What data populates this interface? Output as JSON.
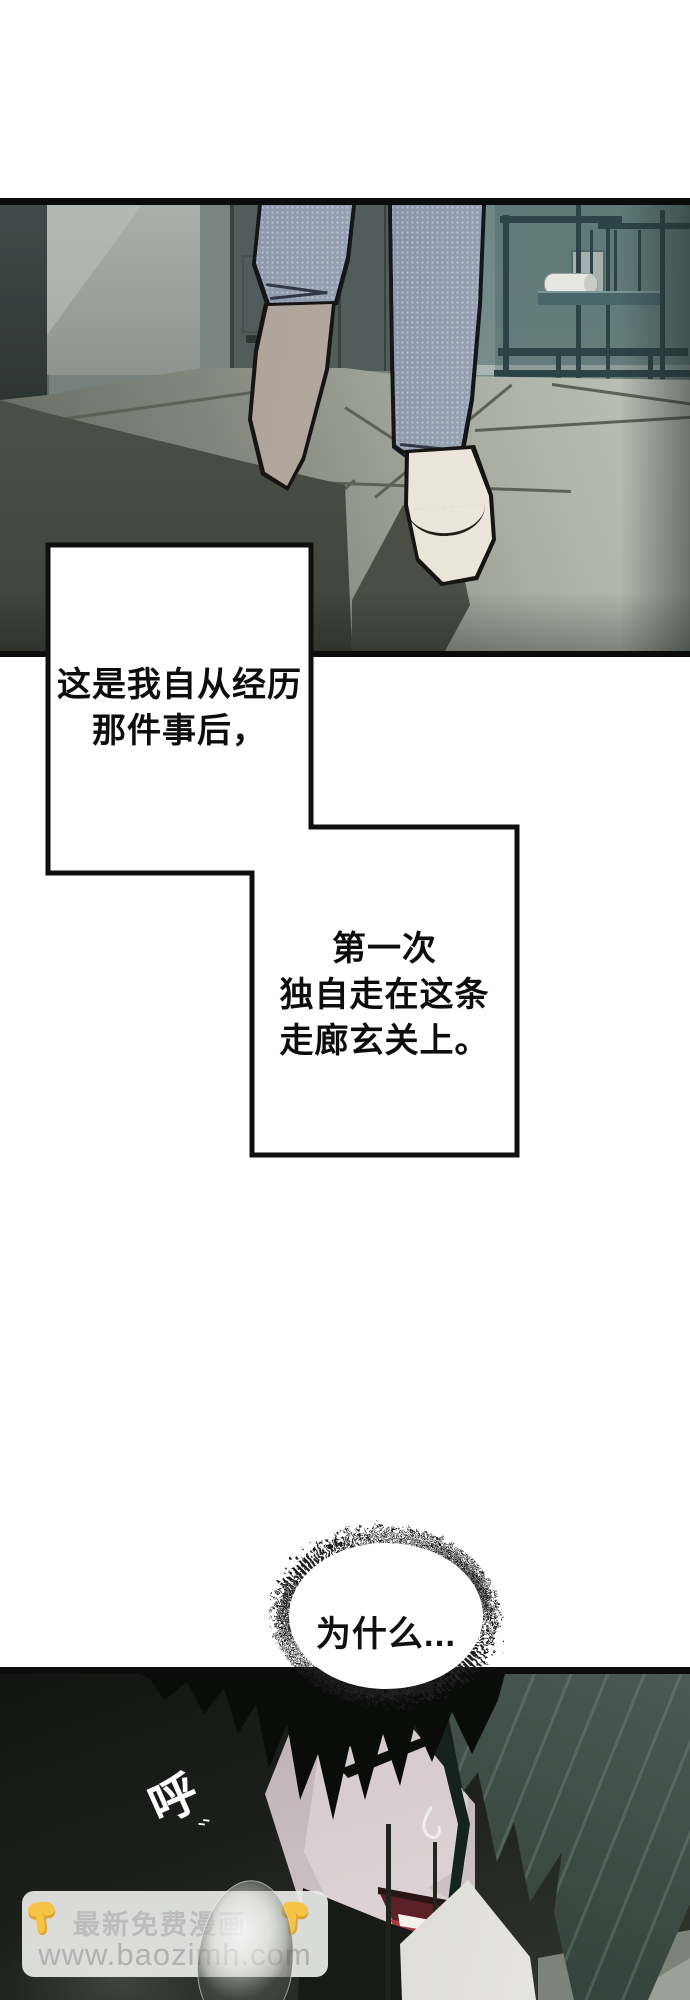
{
  "narration": {
    "box1": {
      "lines": [
        "这是我自从经历",
        "那件事后，"
      ]
    },
    "box2": {
      "lines": [
        "第一次",
        "独自走在这条",
        "走廊玄关上。"
      ]
    }
  },
  "thought": {
    "text": "为什么..."
  },
  "sfx": {
    "breath": "呼",
    "marks": "、、"
  },
  "watermark": {
    "line1": "最新免费漫画",
    "line2": "www.baozimh.com",
    "icon": "hand-pointing-down-icon",
    "box_color": "rgba(234,235,233,0.92)",
    "accent": "#f6c445"
  },
  "colors": {
    "panel_border": "#0c0c0c",
    "jeans": "#9aa4b6",
    "floor_shadow": "#4f5349",
    "hair_black": "#0a0c0a",
    "hair_teal": "#3d4c46",
    "mouth_red": "#a83b42",
    "skin": "#e3d9db"
  }
}
